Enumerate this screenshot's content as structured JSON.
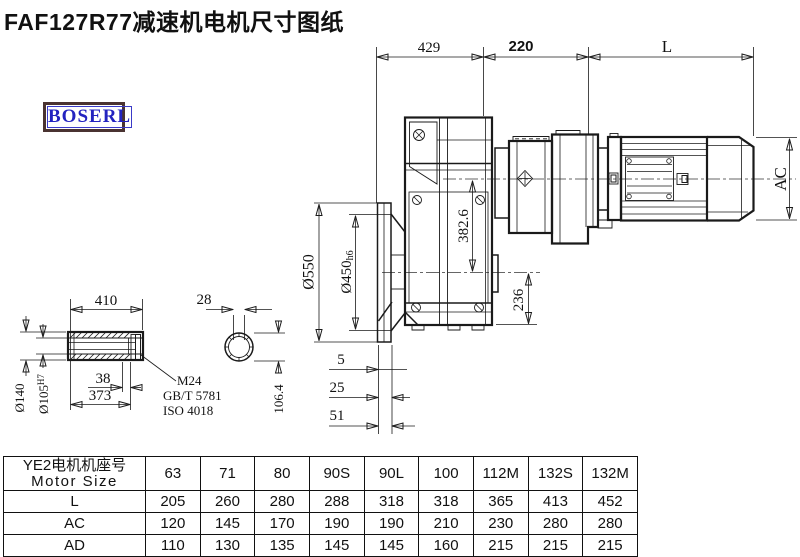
{
  "title": "FAF127R77减速机电机尺寸图纸",
  "logo": "BOSERL",
  "colors": {
    "line": "#1a1a1a",
    "logo_border": "#4a3331",
    "logo_text": "#2323c0"
  },
  "dimensions": {
    "top_429": "429",
    "top_220": "220",
    "top_L": "L",
    "ac": "AC",
    "axis_dist": "382.6",
    "out_236": "236",
    "flange_od": "Ø550",
    "spigot": "Ø450",
    "spigot_tol": "h6",
    "shaft_len": "410",
    "key_w": "28",
    "d38": "38",
    "d373": "373",
    "shaft_od": "Ø140",
    "bore": "Ø105",
    "bore_tol": "H7",
    "across_flat": "106.4",
    "f5": "5",
    "f25": "25",
    "f51": "51"
  },
  "callout": {
    "line1": "M24",
    "line2": "GB/T 5781",
    "line3": "ISO 4018"
  },
  "table": {
    "header_cn": "YE2电机机座号",
    "header_en": "Motor Size",
    "columns": [
      "63",
      "71",
      "80",
      "90S",
      "90L",
      "100",
      "112M",
      "132S",
      "132M"
    ],
    "rows": [
      {
        "label": "L",
        "values": [
          "205",
          "260",
          "280",
          "288",
          "318",
          "318",
          "365",
          "413",
          "452"
        ]
      },
      {
        "label": "AC",
        "values": [
          "120",
          "145",
          "170",
          "190",
          "190",
          "210",
          "230",
          "280",
          "280"
        ]
      },
      {
        "label": "AD",
        "values": [
          "110",
          "130",
          "135",
          "145",
          "145",
          "160",
          "215",
          "215",
          "215"
        ]
      }
    ]
  }
}
